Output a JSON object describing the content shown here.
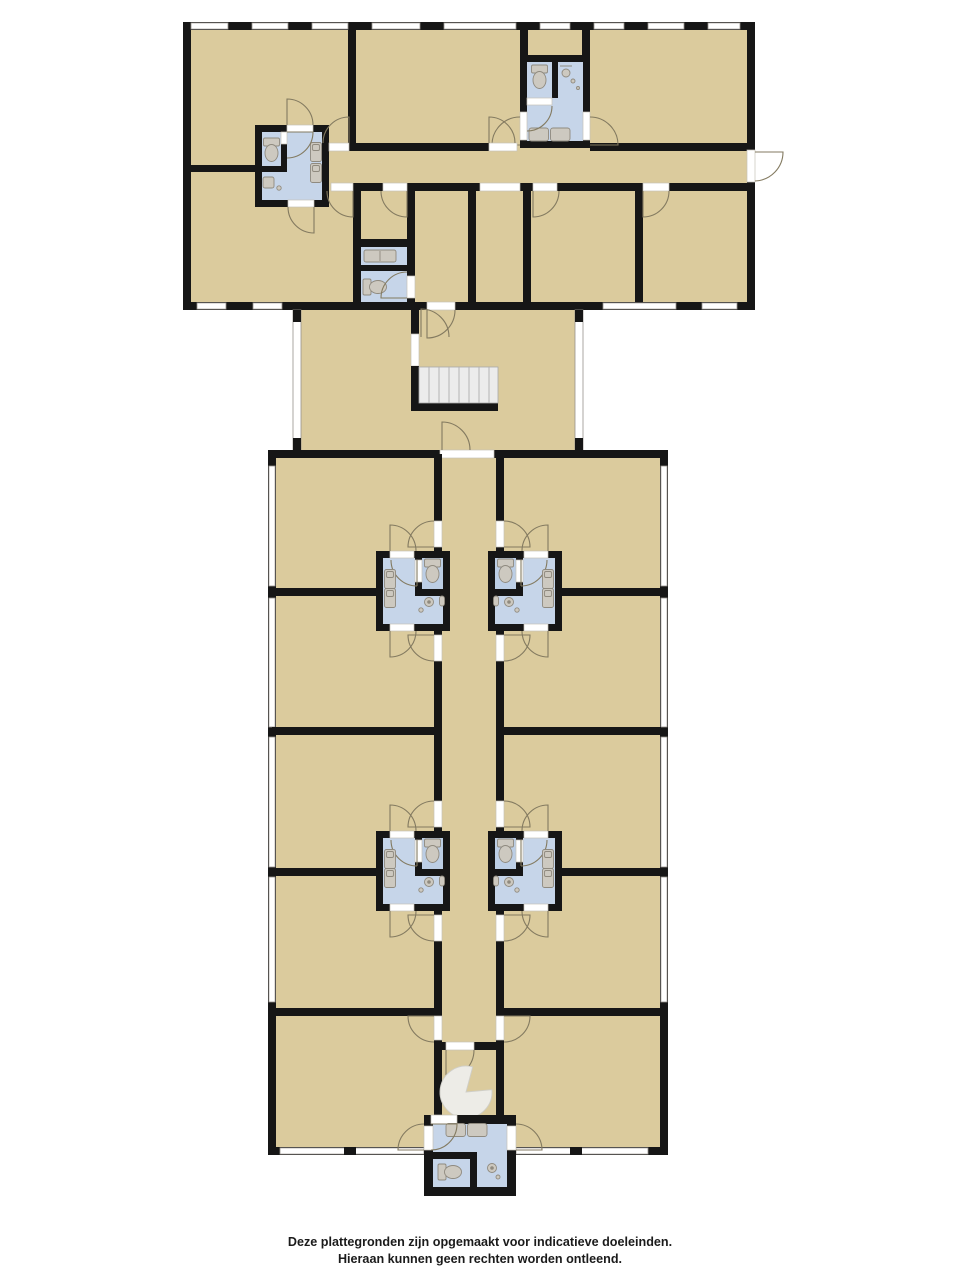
{
  "disclaimer": {
    "line1": "Deze plattegronden zijn opgemaakt voor indicatieve doeleinden.",
    "line2": "Hieraan kunnen geen rechten worden ontleend."
  },
  "colors": {
    "floor": "#dbcb9d",
    "wet_room": "#c6d5e9",
    "wet_room_dark": "#bccee5",
    "wall": "#161616",
    "window_fill": "#ffffff",
    "window_frame": "#96928c",
    "door_arc": "#837a60",
    "stair_fill": "#ececec",
    "stair_line": "#b5b5b5",
    "fixture_fill": "#cdc9c0",
    "fixture_stroke": "#8f8a7f",
    "spiral_fill": "#edece7"
  },
  "legend": {
    "drawing_type": "floor-plan",
    "fixtures": [
      "toilet",
      "sink",
      "double-sink",
      "cabinet",
      "shower-drain",
      "straight-staircase",
      "spiral-staircase",
      "door-swing",
      "window"
    ]
  }
}
